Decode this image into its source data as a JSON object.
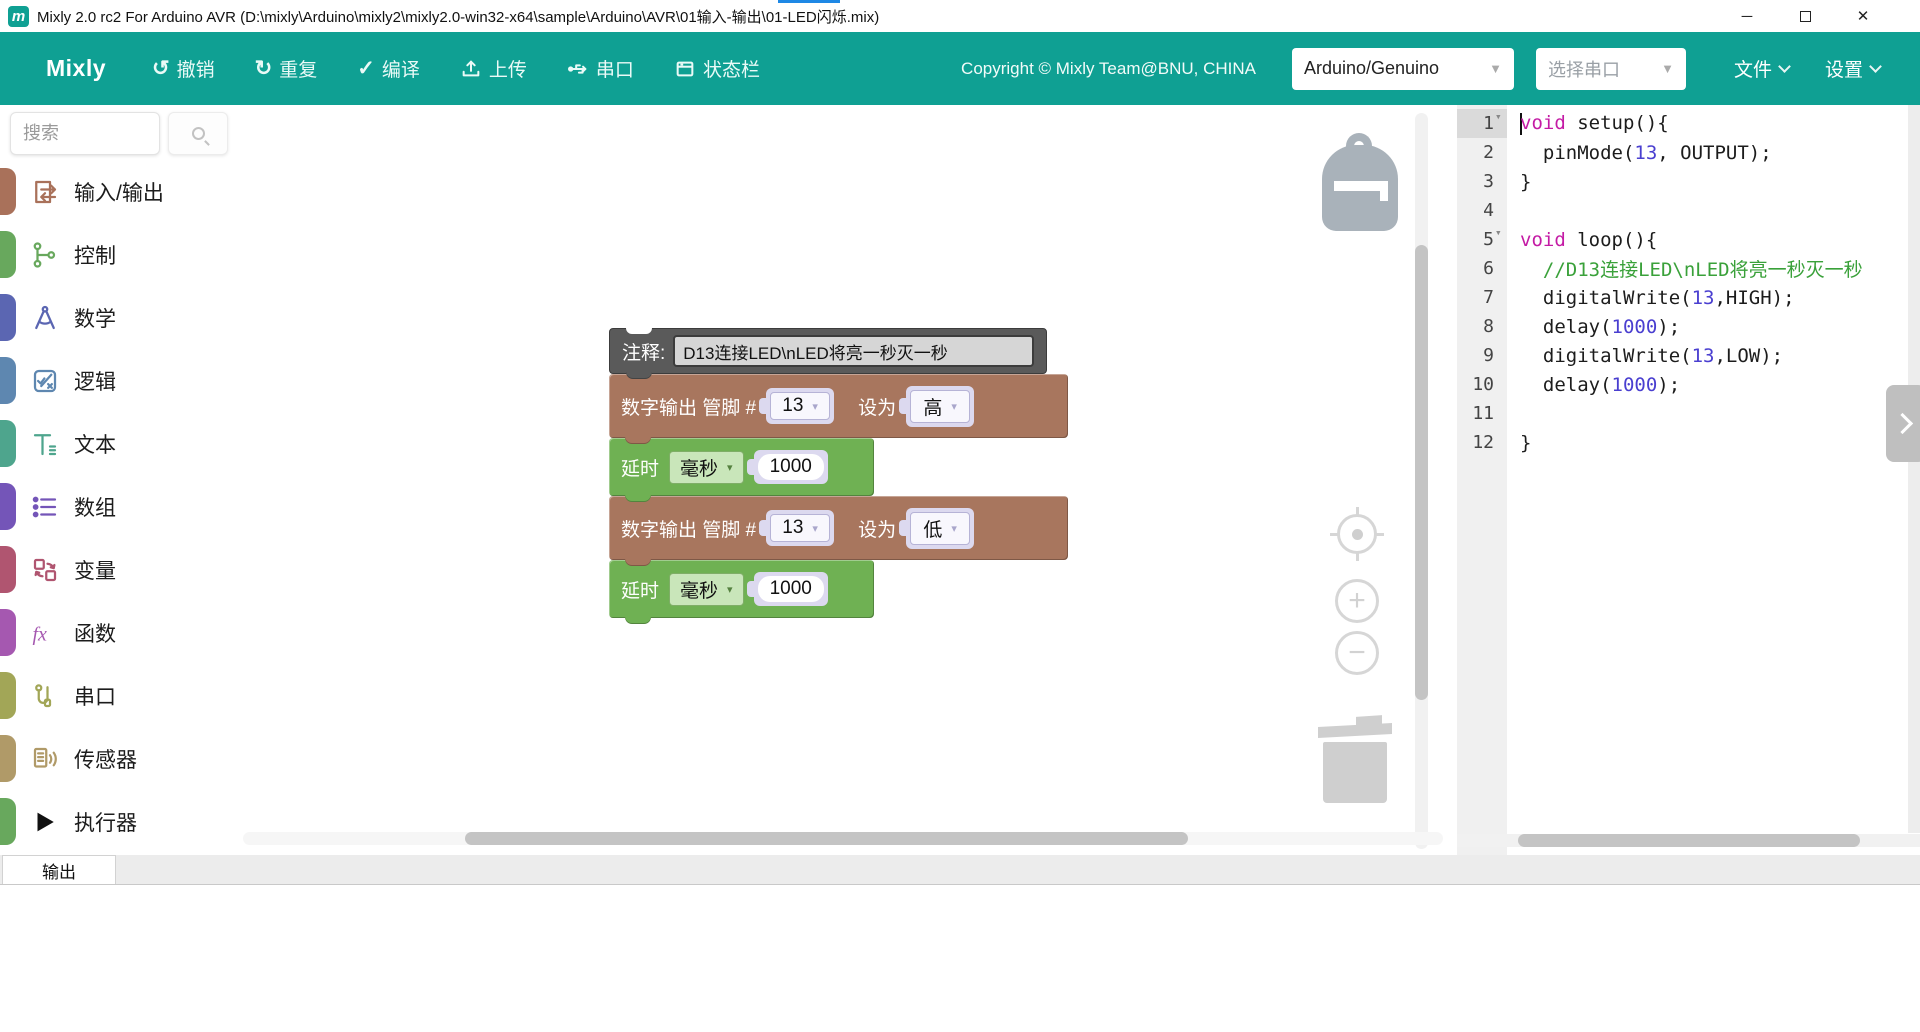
{
  "window": {
    "title": "Mixly 2.0 rc2 For Arduino AVR (D:\\mixly\\Arduino\\mixly2\\mixly2.0-win32-x64\\sample\\Arduino\\AVR\\01输入-输出\\01-LED闪烁.mix)",
    "logo_letter": "m",
    "accent_color": "#1e88e5",
    "controls": {
      "minimize": "─",
      "close": "✕"
    }
  },
  "toolbar": {
    "accent_color": "#0fa093",
    "brand": "Mixly",
    "buttons": [
      {
        "label": "撤销",
        "icon": "undo-icon",
        "glyph": "↺"
      },
      {
        "label": "重复",
        "icon": "redo-icon",
        "glyph": "↻"
      },
      {
        "label": "编译",
        "icon": "compile-icon",
        "glyph": "✓"
      },
      {
        "label": "上传",
        "icon": "upload-icon",
        "glyph": ""
      },
      {
        "label": "串口",
        "icon": "serial-icon",
        "glyph": ""
      },
      {
        "label": "状态栏",
        "icon": "statusbar-icon",
        "glyph": ""
      }
    ],
    "copyright": "Copyright © Mixly Team@BNU, CHINA",
    "board_select": {
      "value": "Arduino/Genuino"
    },
    "port_select": {
      "value": "选择串口"
    },
    "menus": [
      {
        "label": "文件"
      },
      {
        "label": "设置"
      }
    ]
  },
  "sidebar": {
    "search": {
      "placeholder": "搜索"
    },
    "categories": [
      {
        "label": "输入/输出",
        "color": "#a9715a"
      },
      {
        "label": "控制",
        "color": "#68a85d"
      },
      {
        "label": "数学",
        "color": "#5b66b2"
      },
      {
        "label": "逻辑",
        "color": "#5e87b0"
      },
      {
        "label": "文本",
        "color": "#4ea58d"
      },
      {
        "label": "数组",
        "color": "#7455b8"
      },
      {
        "label": "变量",
        "color": "#b05570"
      },
      {
        "label": "函数",
        "color": "#a558b0"
      },
      {
        "label": "串口",
        "color": "#a2a657"
      },
      {
        "label": "传感器",
        "color": "#b09a68"
      },
      {
        "label": "执行器",
        "color": "#68a85d"
      }
    ]
  },
  "workspace": {
    "comment_block": {
      "label": "注释:",
      "value": "D13连接LED\\nLED将亮一秒灭一秒",
      "color": "#5a5a5a"
    },
    "digital_write_1": {
      "prefix": "数字输出 管脚 #",
      "pin": "13",
      "set_label": "设为",
      "value": "高",
      "color": "#a8765e"
    },
    "delay_1": {
      "label": "延时",
      "unit": "毫秒",
      "value": "1000",
      "color": "#6fb153"
    },
    "digital_write_2": {
      "prefix": "数字输出 管脚 #",
      "pin": "13",
      "set_label": "设为",
      "value": "低",
      "color": "#a8765e"
    },
    "delay_2": {
      "label": "延时",
      "unit": "毫秒",
      "value": "1000",
      "color": "#6fb153"
    },
    "icons": [
      "backpack-icon",
      "zoom-reset-icon",
      "zoom-in-icon",
      "zoom-out-icon",
      "trash-icon"
    ]
  },
  "code_panel": {
    "colors": {
      "keyword": "#c41ba5",
      "number": "#4a3fd0",
      "comment": "#3aa13a",
      "plain": "#1c1c1c"
    },
    "lines": [
      {
        "n": 1,
        "fold": true,
        "active": true,
        "cursor": true,
        "segments": [
          {
            "t": "void",
            "c": "kw"
          },
          {
            "t": " setup(){",
            "c": "pl"
          }
        ]
      },
      {
        "n": 2,
        "segments": [
          {
            "t": "  pinMode(",
            "c": "pl"
          },
          {
            "t": "13",
            "c": "num"
          },
          {
            "t": ", OUTPUT);",
            "c": "pl"
          }
        ]
      },
      {
        "n": 3,
        "segments": [
          {
            "t": "}",
            "c": "pl"
          }
        ]
      },
      {
        "n": 4,
        "segments": []
      },
      {
        "n": 5,
        "fold": true,
        "segments": [
          {
            "t": "void",
            "c": "kw"
          },
          {
            "t": " loop(){",
            "c": "pl"
          }
        ]
      },
      {
        "n": 6,
        "segments": [
          {
            "t": "  //D13连接LED\\nLED将亮一秒灭一秒",
            "c": "com"
          }
        ]
      },
      {
        "n": 7,
        "segments": [
          {
            "t": "  digitalWrite(",
            "c": "pl"
          },
          {
            "t": "13",
            "c": "num"
          },
          {
            "t": ",HIGH);",
            "c": "pl"
          }
        ]
      },
      {
        "n": 8,
        "segments": [
          {
            "t": "  delay(",
            "c": "pl"
          },
          {
            "t": "1000",
            "c": "num"
          },
          {
            "t": ");",
            "c": "pl"
          }
        ]
      },
      {
        "n": 9,
        "segments": [
          {
            "t": "  digitalWrite(",
            "c": "pl"
          },
          {
            "t": "13",
            "c": "num"
          },
          {
            "t": ",LOW);",
            "c": "pl"
          }
        ]
      },
      {
        "n": 10,
        "segments": [
          {
            "t": "  delay(",
            "c": "pl"
          },
          {
            "t": "1000",
            "c": "num"
          },
          {
            "t": ");",
            "c": "pl"
          }
        ]
      },
      {
        "n": 11,
        "segments": []
      },
      {
        "n": 12,
        "segments": [
          {
            "t": "}",
            "c": "pl"
          }
        ]
      }
    ]
  },
  "bottom_panel": {
    "tab": "输出"
  }
}
